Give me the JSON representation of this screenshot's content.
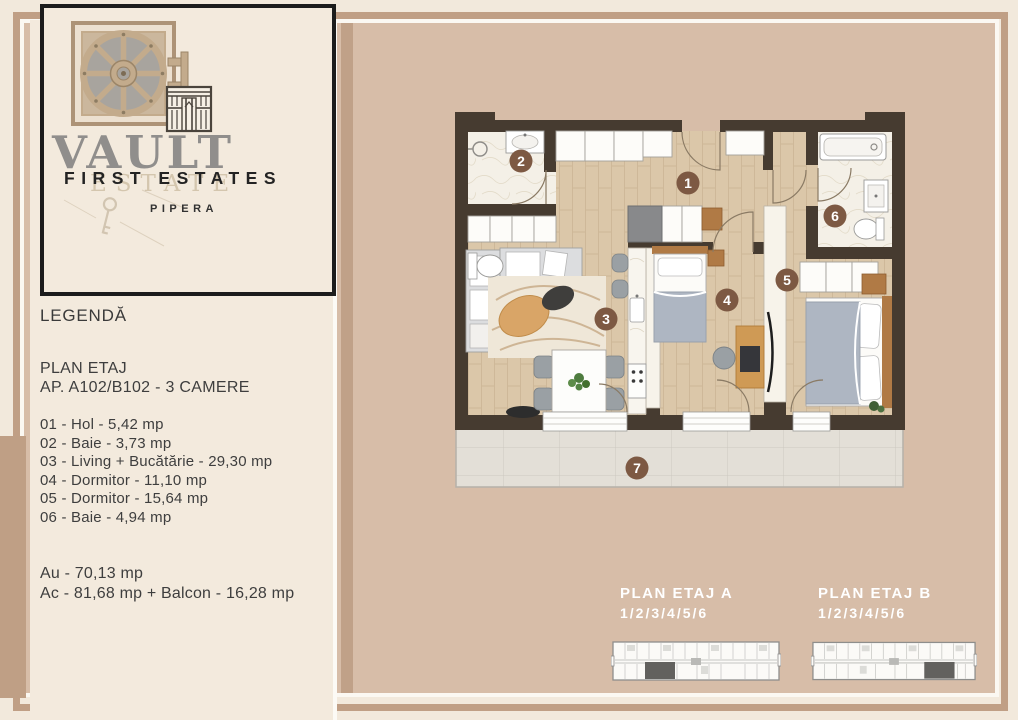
{
  "colors": {
    "frame_tan": "#c09f85",
    "card_tan": "#d7bda8",
    "cream": "#f3eadd",
    "wall_dark": "#463b30",
    "number_circle": "#7d5943",
    "footer_label": "#ffffff"
  },
  "logo": {
    "brand": "VAULT",
    "watermark": "ESTATE",
    "subtitle": "FIRST ESTATES",
    "location": "PIPERA"
  },
  "legend": {
    "title": "LEGENDĂ",
    "plan_heading": "PLAN ETAJ",
    "apartment_line": "AP. A102/B102 - 3 CAMERE",
    "rooms": [
      "01 - Hol - 5,42 mp",
      "02 - Baie - 3,73 mp",
      "03 - Living + Bucătărie - 29,30 mp",
      "04 - Dormitor - 11,10 mp",
      "05 - Dormitor - 15,64 mp",
      "06 - Baie - 4,94 mp"
    ],
    "totals": [
      "Au - 70,13 mp",
      "Ac - 81,68 mp + Balcon - 16,28 mp"
    ]
  },
  "floorplan": {
    "numbers": [
      "1",
      "2",
      "3",
      "4",
      "5",
      "6",
      "7"
    ]
  },
  "floor_plans_footer": {
    "plan_a": {
      "title": "PLAN ETAJ A",
      "levels": "1/2/3/4/5/6"
    },
    "plan_b": {
      "title": "PLAN ETAJ B",
      "levels": "1/2/3/4/5/6"
    }
  }
}
